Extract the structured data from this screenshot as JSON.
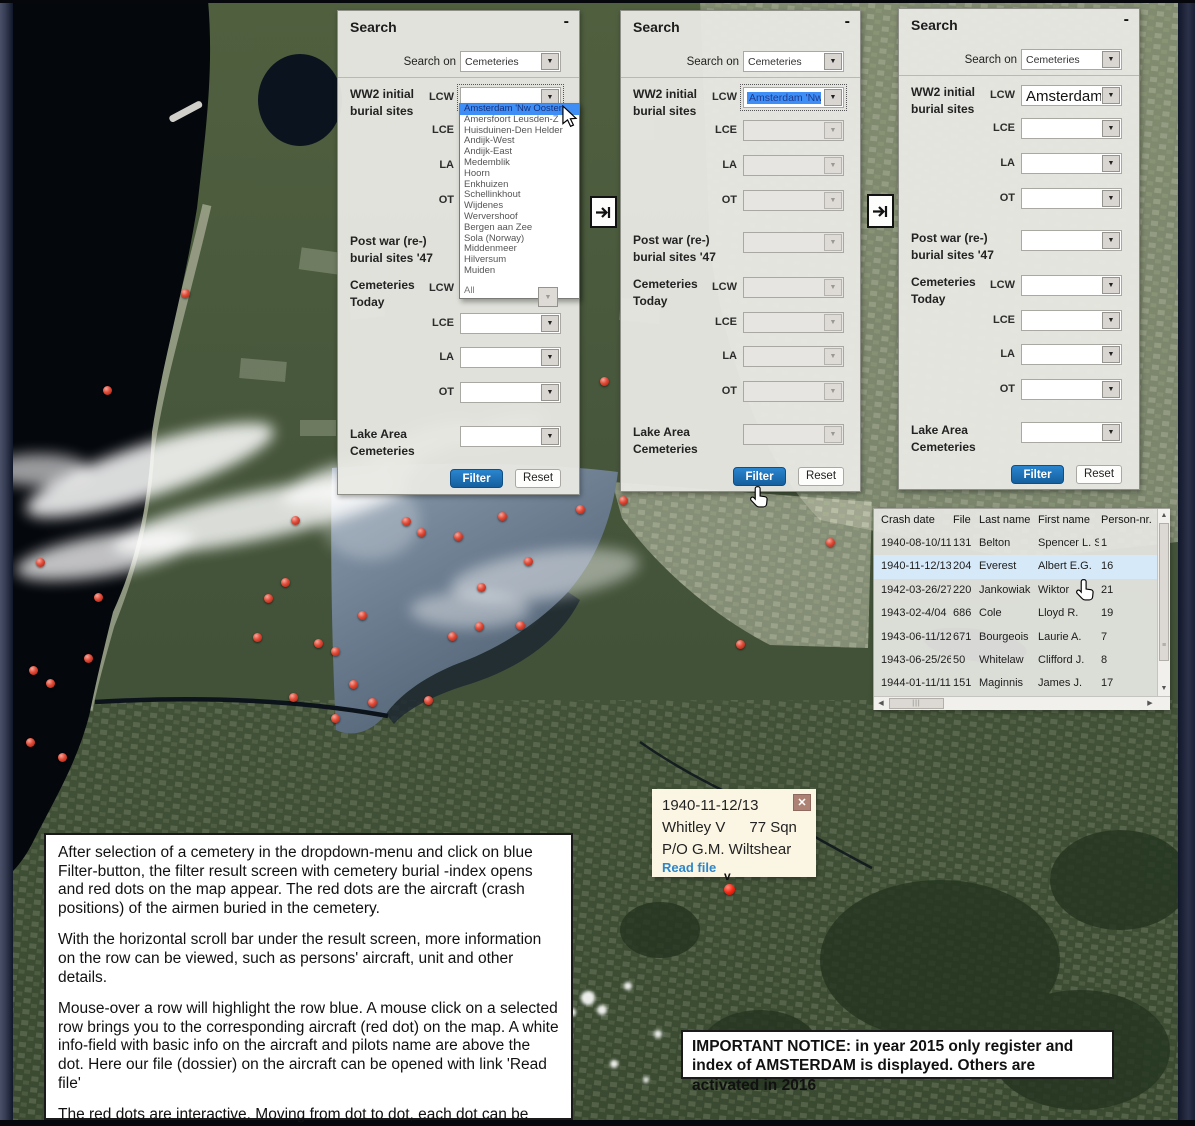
{
  "map": {
    "sea_color": "#04070c",
    "land_color": "#46553a",
    "lake_color": "#68798c",
    "dot_color": "#d93425",
    "dots": [
      [
        185,
        293
      ],
      [
        107,
        390
      ],
      [
        295,
        520
      ],
      [
        40,
        562
      ],
      [
        285,
        582
      ],
      [
        268,
        598
      ],
      [
        98,
        597
      ],
      [
        257,
        637
      ],
      [
        318,
        643
      ],
      [
        88,
        658
      ],
      [
        33,
        670
      ],
      [
        50,
        683
      ],
      [
        293,
        697
      ],
      [
        30,
        742
      ],
      [
        62,
        757
      ],
      [
        406,
        521
      ],
      [
        421,
        532
      ],
      [
        458,
        536
      ],
      [
        502,
        516
      ],
      [
        580,
        509
      ],
      [
        623,
        500
      ],
      [
        528,
        561
      ],
      [
        481,
        587
      ],
      [
        362,
        615
      ],
      [
        520,
        625
      ],
      [
        479,
        626
      ],
      [
        452,
        636
      ],
      [
        335,
        651
      ],
      [
        353,
        684
      ],
      [
        372,
        702
      ],
      [
        428,
        700
      ],
      [
        335,
        718
      ],
      [
        740,
        644
      ],
      [
        830,
        542
      ],
      [
        604,
        381
      ]
    ]
  },
  "panel_labels": {
    "title": "Search",
    "minimize": "-",
    "search_on": "Search on",
    "search_on_value": "Cemeteries",
    "ww2_line1": "WW2 initial",
    "ww2_line2": "burial sites",
    "postwar_line1": "Post war (re-)",
    "postwar_line2": "burial sites '47",
    "today_line1": "Cemeteries",
    "today_line2": "Today",
    "lake_line1": "Lake Area",
    "lake_line2": "Cemeteries",
    "lcw": "LCW",
    "lce": "LCE",
    "la": "LA",
    "ot": "OT",
    "filter": "Filter",
    "reset": "Reset"
  },
  "panels": [
    {
      "lcw_value": ""
    },
    {
      "lcw_value": "Amsterdam 'Nw O"
    },
    {
      "lcw_value": "Amsterdam"
    }
  ],
  "dropdown": {
    "items": [
      "Amsterdam 'Nw Ooster",
      "Amersfoort Leusden-Z",
      "Huisduinen-Den Helder",
      "Andijk-West",
      "Andijk-East",
      "Medemblik",
      "Hoorn",
      "Enkhuizen",
      "Schellinkhout",
      "Wijdenes",
      "Wervershoof",
      "Bergen aan Zee",
      "Sola (Norway)",
      "Middenmeer",
      "Hilversum",
      "Muiden"
    ],
    "highlighted_index": 0,
    "footer_item": "All"
  },
  "results_table": {
    "columns": [
      "Crash date",
      "File",
      "Last name",
      "First name",
      "Person-nr."
    ],
    "rows": [
      [
        "1940-08-10/11",
        "131",
        "Belton",
        "Spencer L. S.",
        "1"
      ],
      [
        "1940-11-12/13",
        "204",
        "Everest",
        "Albert E.G.",
        "16"
      ],
      [
        "1942-03-26/27",
        "220",
        "Jankowiak",
        "Wiktor",
        "21"
      ],
      [
        "1943-02-4/04",
        "686",
        "Cole",
        "Lloyd R.",
        "19"
      ],
      [
        "1943-06-11/12",
        "671",
        "Bourgeois",
        "Laurie A.",
        "7"
      ],
      [
        "1943-06-25/26",
        "50",
        "Whitelaw",
        "Clifford J.",
        "8"
      ],
      [
        "1944-01-11/11",
        "151",
        "Maginnis",
        "James J.",
        "17"
      ]
    ],
    "highlighted_row_index": 1
  },
  "info_popup": {
    "date": "1940-11-12/13",
    "aircraft": "Whitley V",
    "squadron": "77 Sqn",
    "pilot": "P/O  G.M. Wiltshear",
    "read_file": "Read file",
    "close": "✕",
    "marker": "v"
  },
  "instructions_box": {
    "paragraphs": [
      "After selection of a cemetery in the dropdown-menu and click on blue Filter-button, the filter result screen with cemetery burial -index opens and red dots on the map appear. The red dots are the aircraft (crash positions) of the airmen buried in the cemetery.",
      "With the horizontal scroll bar under the result screen, more information on the row can be viewed, such as persons' aircraft, unit and other details.",
      "Mouse-over a row will highlight the row blue. A mouse click on a selected row brings you to the corresponding aircraft (red dot) on the map. A white info-field with basic info on the aircraft and pilots name are above the dot. Here our file (dossier) on the aircraft can be opened with link 'Read file'",
      "The red dots are interactive. Moving from dot to dot, each dot can be asked for its info-field with a mouse click."
    ]
  },
  "notice_box": {
    "text": "IMPORTANT NOTICE:  in year 2015 only register and index of  AMSTERDAM  is displayed. Others are activated in 2016"
  }
}
